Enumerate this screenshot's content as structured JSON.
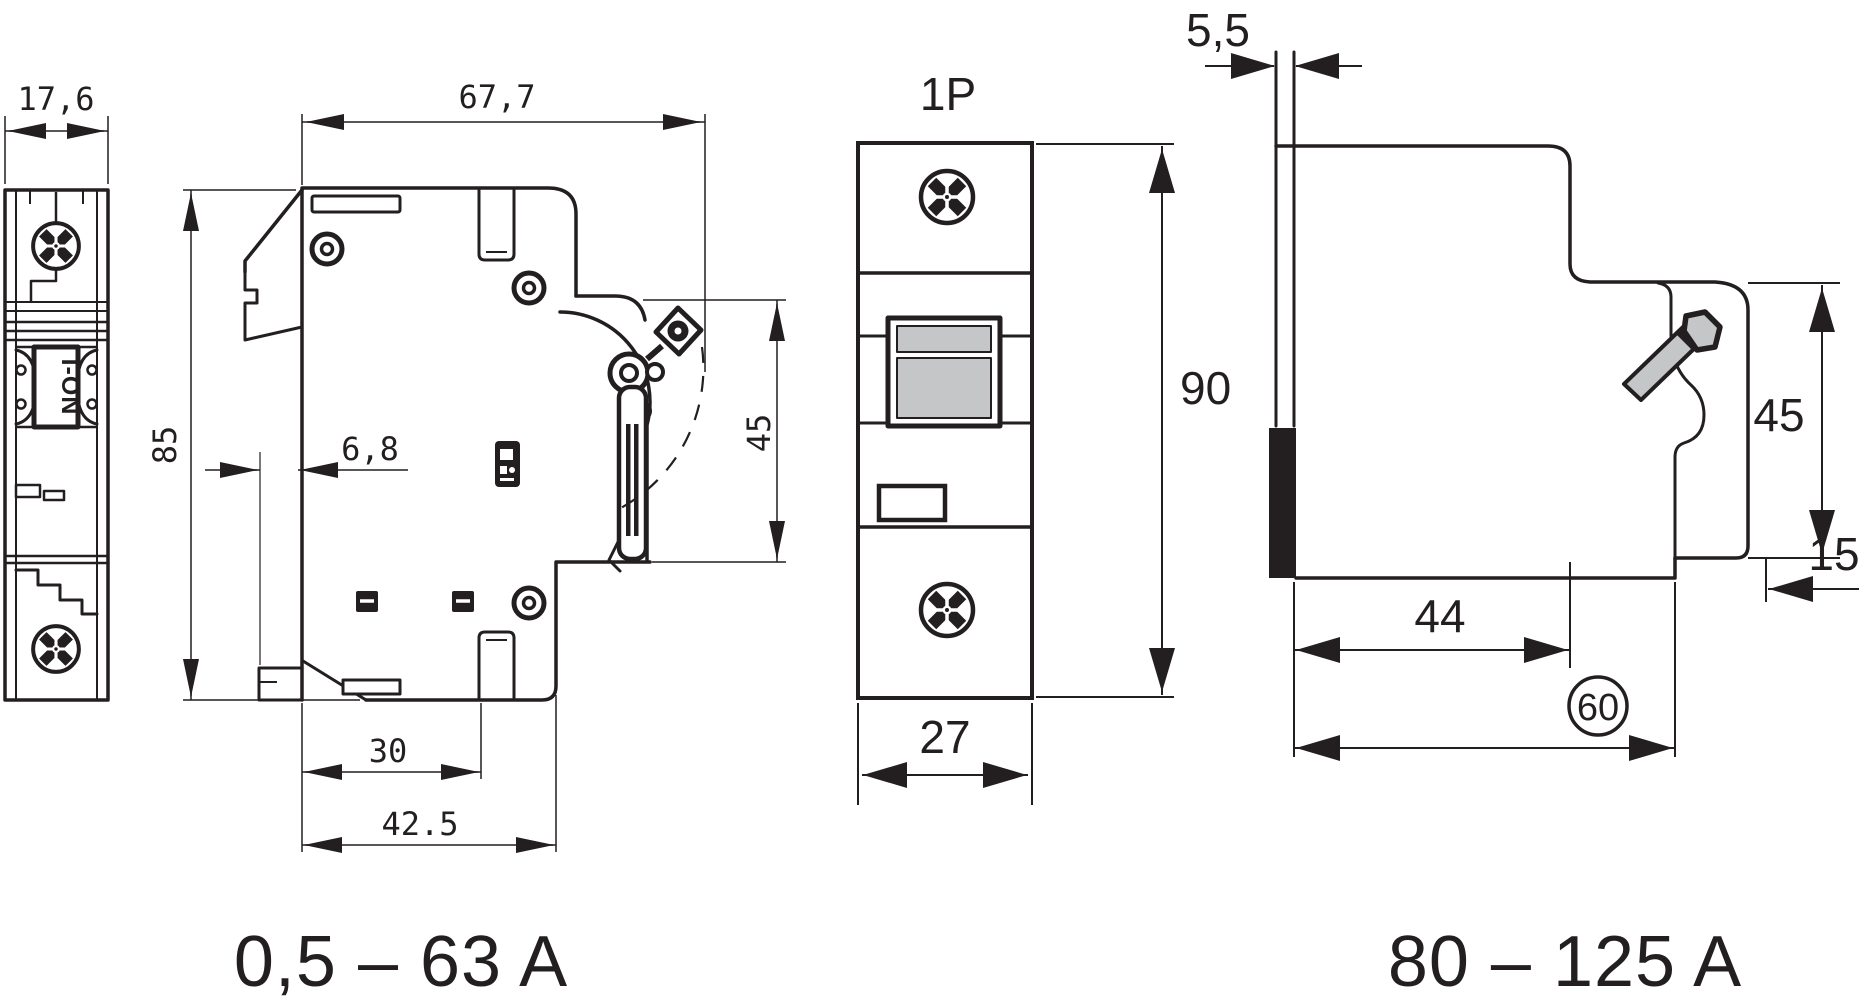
{
  "colors": {
    "line": "#231f20",
    "gray_fill": "#c5c6c8",
    "background": "#ffffff"
  },
  "views": {
    "front_small": {
      "width_dim": "17,6",
      "switch_label": "I-ON"
    },
    "side_small": {
      "depth_dim": "67,7",
      "height_dim": "85",
      "clip_offset_dim": "6,8",
      "front_height_dim": "45",
      "slot_depth_dim": "30",
      "lower_depth_dim": "42.5",
      "range_label": "0,5 – 63 A"
    },
    "front_1p": {
      "pole_label": "1P",
      "width_dim": "27",
      "height_dim": "90"
    },
    "side_large": {
      "tab_dim": "5,5",
      "front_height_dim": "45",
      "step_dim": "15",
      "top_depth_dim": "44",
      "bottom_depth_dim": "60",
      "range_label": "80 – 125 A"
    }
  }
}
